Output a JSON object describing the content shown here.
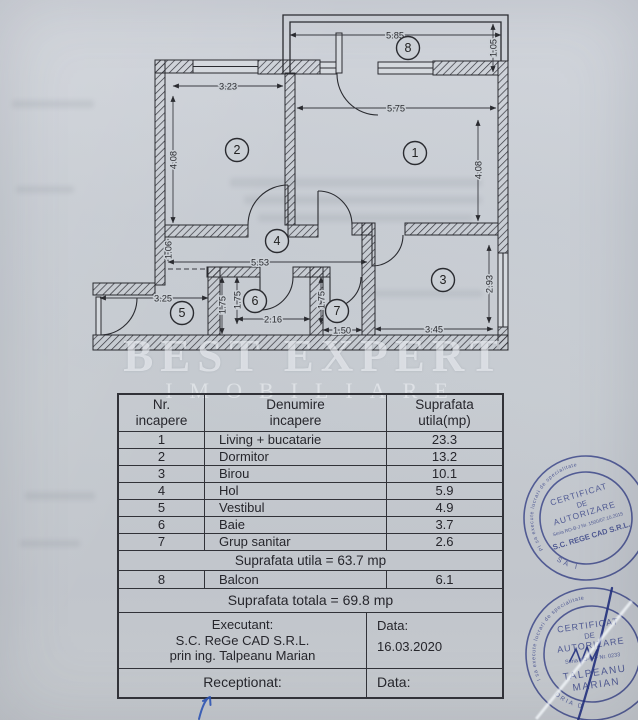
{
  "paper": {
    "watermark_line1": "BEST EXPERT",
    "watermark_line2": "IMOBILIARE"
  },
  "plan": {
    "room_numbers": [
      "1",
      "2",
      "3",
      "4",
      "5",
      "6",
      "7",
      "8"
    ],
    "dims": {
      "balcon_width": "5.85",
      "balcon_depth": "1.05",
      "dormitor_width": "3.23",
      "dormitor_height": "4.08",
      "living_width": "5.75",
      "living_height": "4.08",
      "hol_height": "1.06",
      "hol_width": "5.53",
      "vestibul_width": "3.25",
      "baie_height_a": "1.75",
      "baie_height_b": "1.75",
      "baie_width": "2.16",
      "grup_height": "1.75",
      "grup_width": "1.50",
      "birou_width": "3.45",
      "birou_height": "2.93"
    }
  },
  "table": {
    "headers": [
      [
        "Nr.",
        "incapere"
      ],
      [
        "Denumire",
        "incapere"
      ],
      [
        "Suprafata",
        "utila(mp)"
      ]
    ],
    "rows": [
      {
        "nr": "1",
        "name": "Living + bucatarie",
        "area": "23.3"
      },
      {
        "nr": "2",
        "name": "Dormitor",
        "area": "13.2"
      },
      {
        "nr": "3",
        "name": "Birou",
        "area": "10.1"
      },
      {
        "nr": "4",
        "name": "Hol",
        "area": "5.9"
      },
      {
        "nr": "5",
        "name": "Vestibul",
        "area": "4.9"
      },
      {
        "nr": "6",
        "name": "Baie",
        "area": "3.7"
      },
      {
        "nr": "7",
        "name": "Grup sanitar",
        "area": "2.6"
      }
    ],
    "subtotal": "Suprafata utila = 63.7 mp",
    "balcony_row": {
      "nr": "8",
      "name": "Balcon",
      "area": "6.1"
    },
    "total": "Suprafata totala = 69.8 mp",
    "executant_label": "Executant:",
    "executant_line1": "S.C. ReGe CAD S.R.L.",
    "executant_line2": "prin ing. Talpeanu Marian",
    "data_label": "Data:",
    "data_value": "16.03.2020",
    "receptionat_label": "Receptionat:",
    "receptionat_data_label": "Data:"
  },
  "stamps": {
    "stamp1": {
      "ring_text": "Persoana juridica autorizata de ANCPI sa execute lucrari de specialitate",
      "line1": "CERTIFICAT",
      "line2": "DE",
      "line3": "AUTORIZARE",
      "line4": "Seria RO-B-J Nr. 1500/07.10.2015",
      "line5": "S.C. REGE CAD S.R.L.",
      "bottom": "CLASA I"
    },
    "stamp2": {
      "ring_text": "Persoana fizica autorizata de ANCPI sa execute lucrari de specialitate",
      "line1": "CERTIFICAT",
      "line2": "DE",
      "line3": "AUTORIZARE",
      "line4": "Seria RO-B-F Nr. 0233",
      "line5": "TALPEANU",
      "line6": "MARIAN",
      "bottom": "CATEGORIA D"
    }
  }
}
